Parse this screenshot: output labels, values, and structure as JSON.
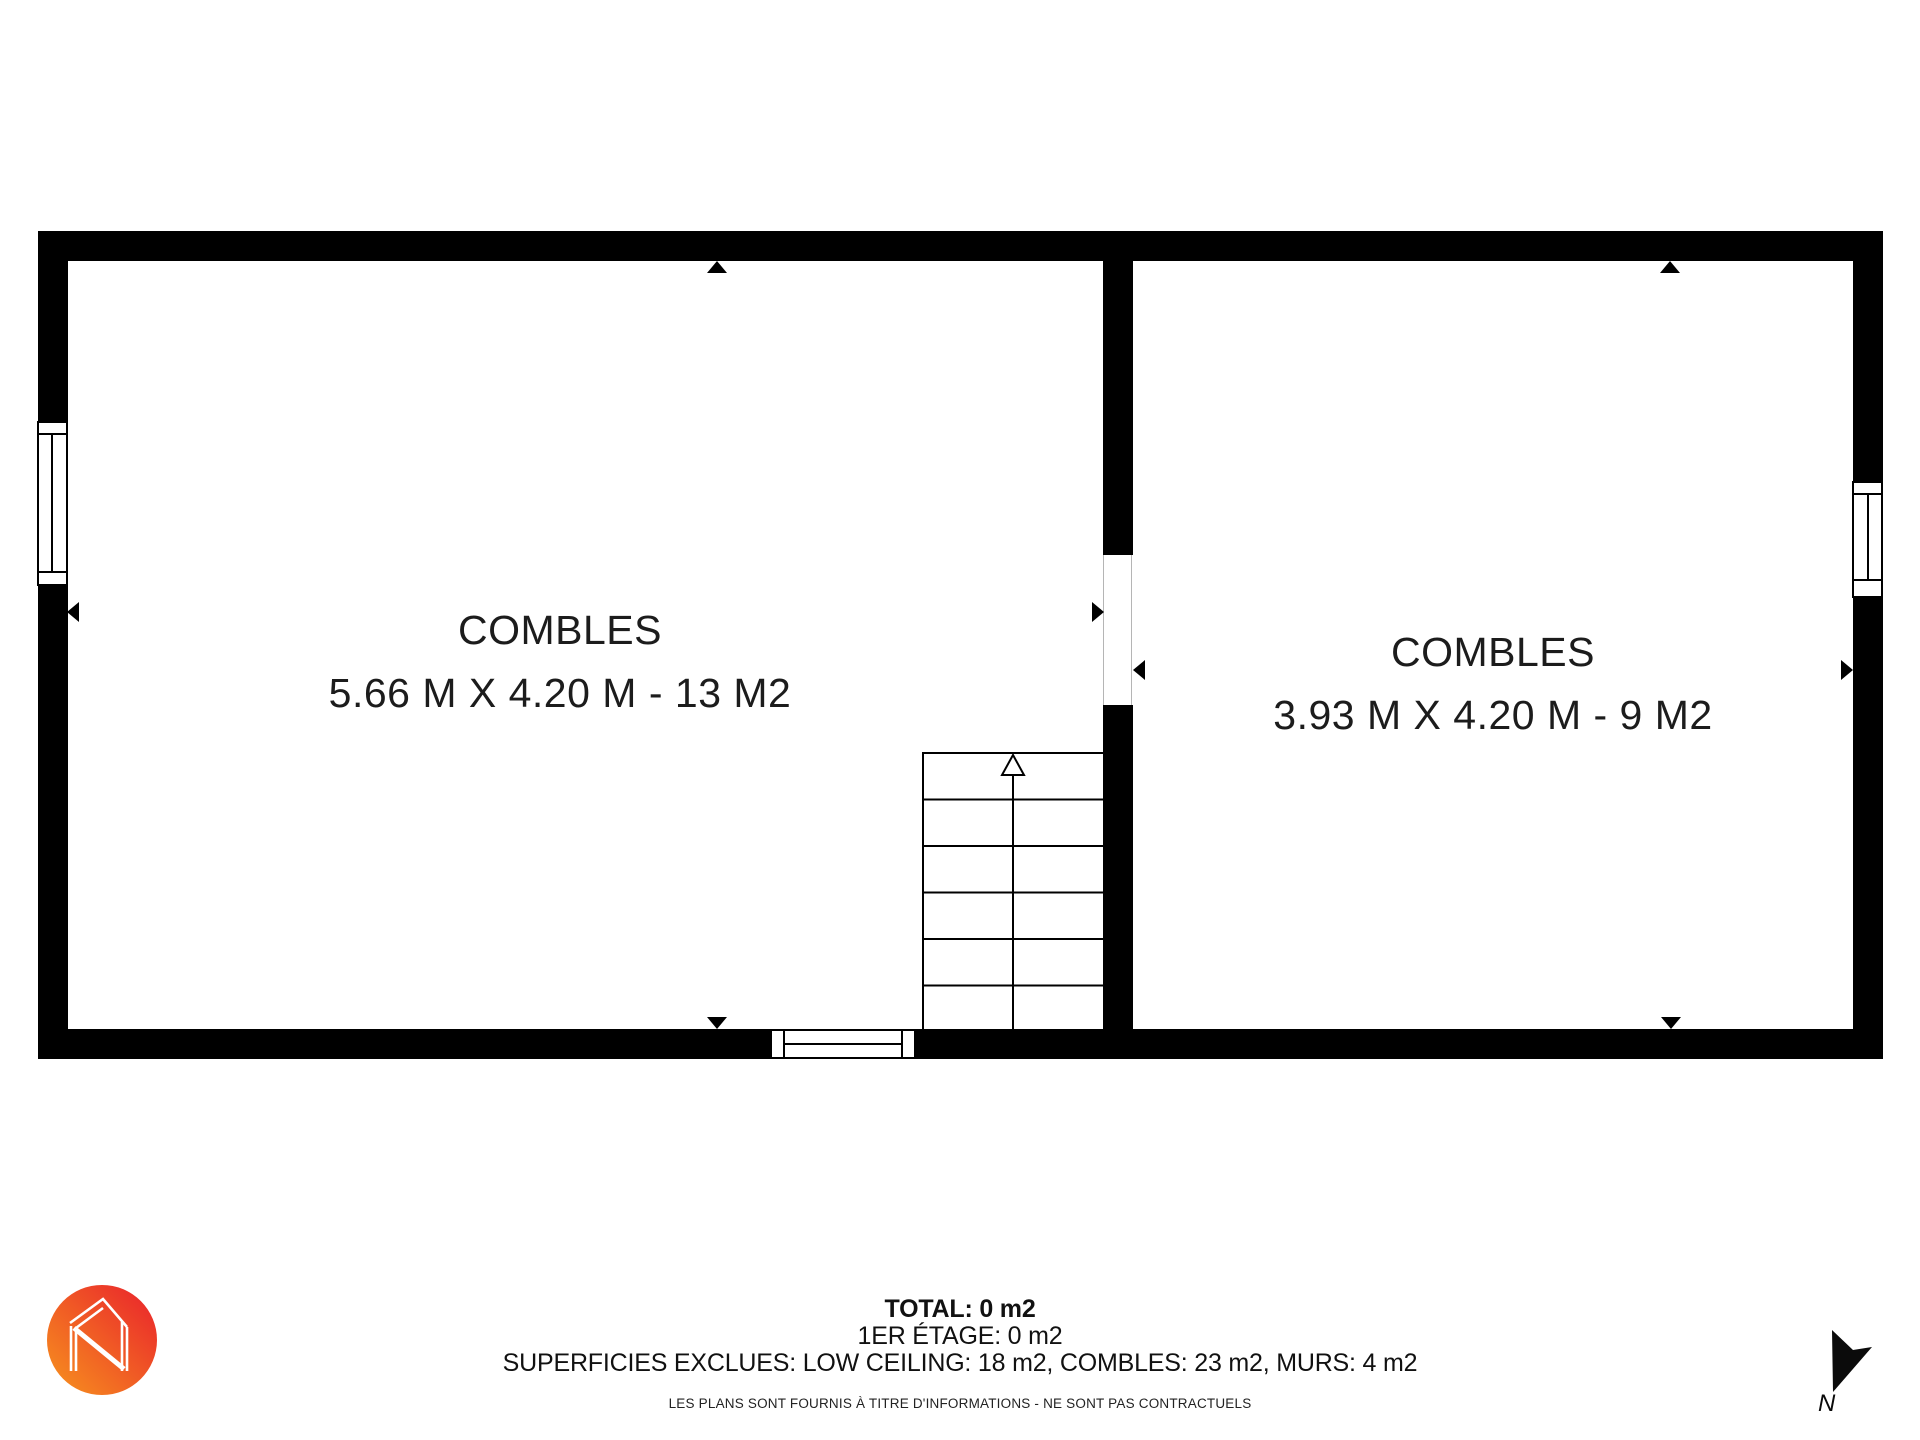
{
  "plan": {
    "rooms": [
      {
        "name": "COMBLES",
        "dimensions": "5.66 M X 4.20 M - 13 M2"
      },
      {
        "name": "COMBLES",
        "dimensions": "3.93 M X 4.20 M - 9 M2"
      }
    ]
  },
  "summary": {
    "total": "TOTAL: 0 m2",
    "floor": "1ER ÉTAGE: 0 m2",
    "excluded": "SUPERFICIES EXCLUES: LOW CEILING: 18 m2, COMBLES: 23 m2, MURS: 4 m2",
    "disclaimer": "LES PLANS SONT FOURNIS À TITRE D'INFORMATIONS - NE SONT PAS CONTRACTUELS"
  },
  "compass": {
    "label": "N",
    "icon": "north-arrow-icon"
  },
  "branding": {
    "icon": "house-n-logo"
  },
  "colors": {
    "wall": "#000000",
    "background": "#ffffff",
    "logo_gradient_start": "#F7941E",
    "logo_gradient_end": "#E9202C"
  }
}
